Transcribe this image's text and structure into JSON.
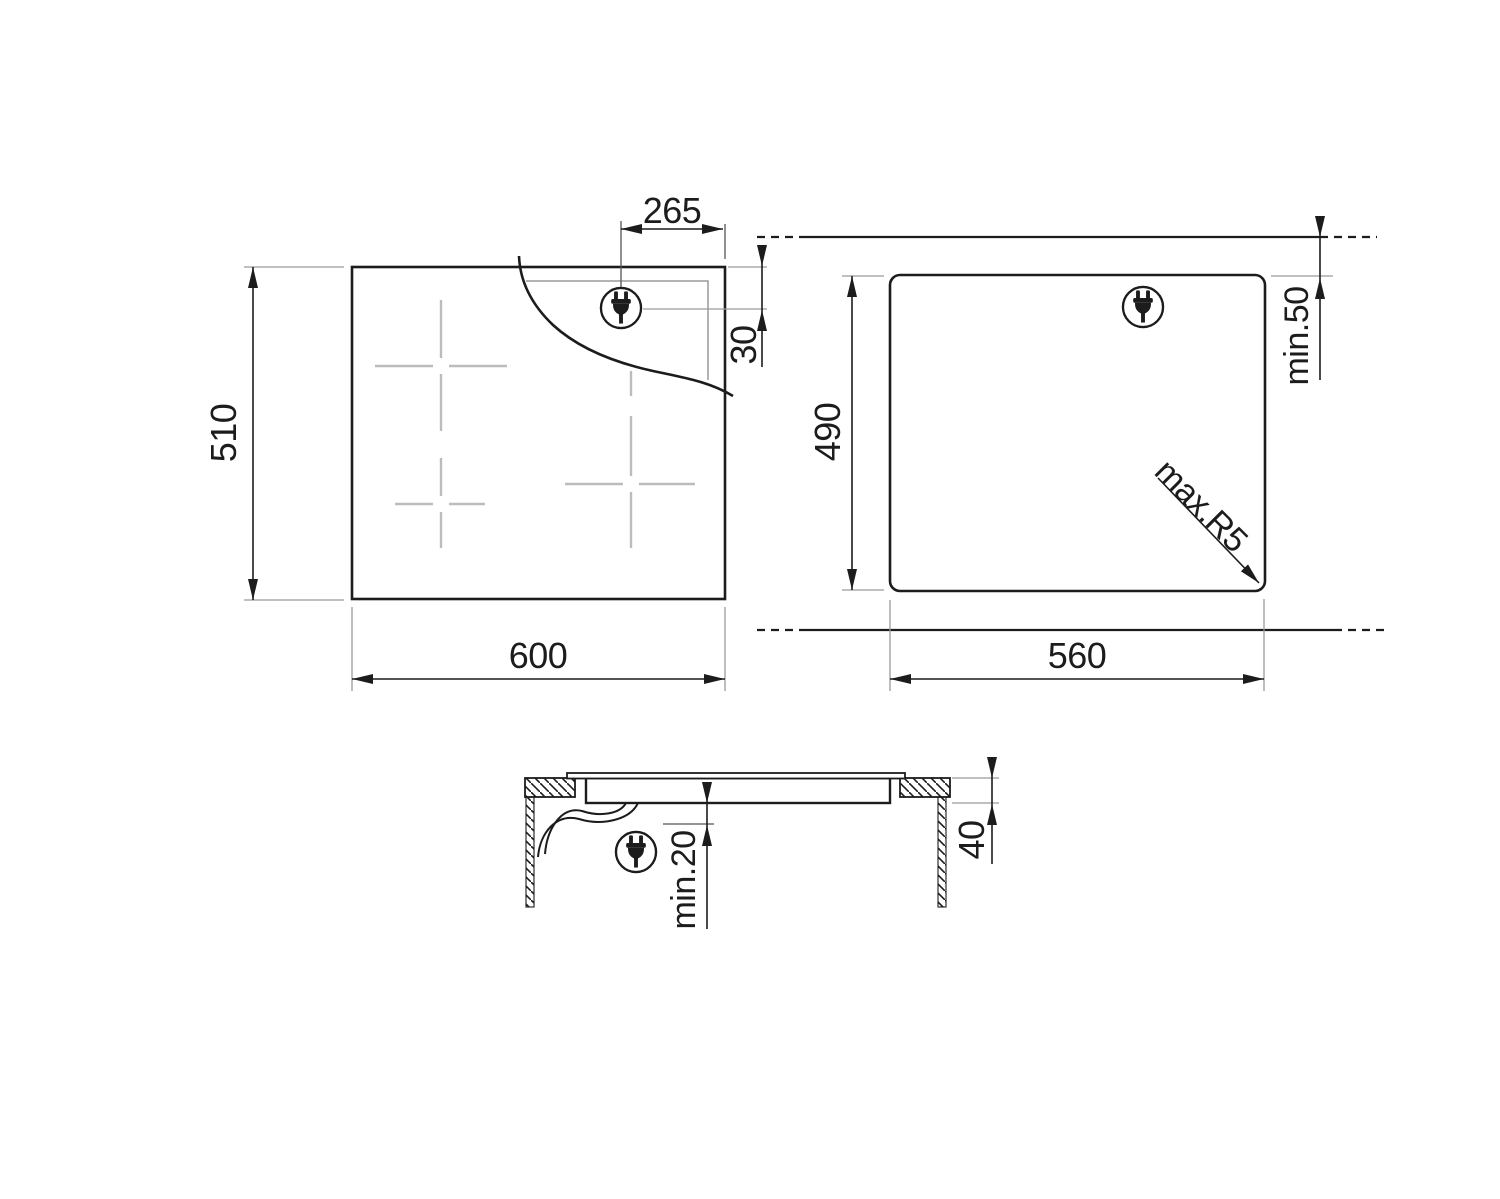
{
  "drawing": {
    "top_view": {
      "width": "600",
      "height": "510",
      "plug_offset_x": "265",
      "plug_offset_y": "30"
    },
    "cutout_view": {
      "width": "560",
      "height": "490",
      "rear_clearance": "min.50",
      "corner_radius": "max.R5"
    },
    "side_view": {
      "hob_height": "40",
      "bottom_clearance": "min.20"
    },
    "icons": {
      "plug": "power-plug-icon"
    },
    "colors": {
      "line": "#1c1c1c",
      "aux": "#9a9a9a",
      "marker": "#bcbcbc",
      "background": "#ffffff"
    }
  }
}
